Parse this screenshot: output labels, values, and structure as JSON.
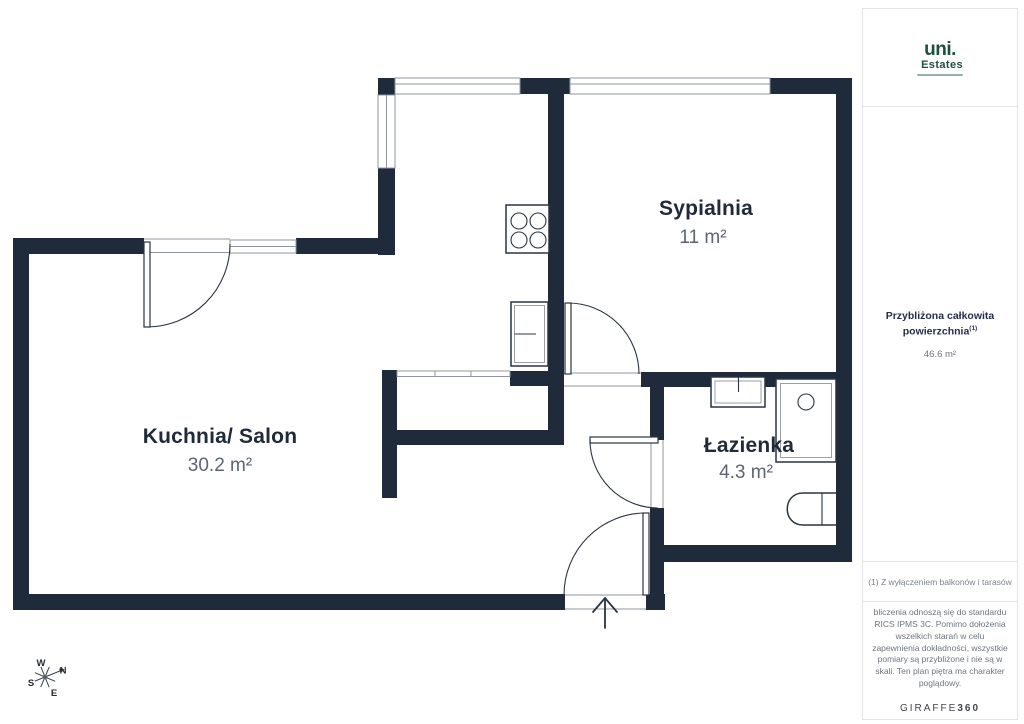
{
  "colors": {
    "wall": "#1f2a3a",
    "room_name": "#1f2a3a",
    "room_area": "#5d6572",
    "thin_line": "#8f959e",
    "fixture_line": "#2a3442",
    "sidebar_border": "#e4e4e4",
    "sidebar_text": "#6e757f",
    "heading": "#23304a",
    "logo_green": "#1d4f3c",
    "brand_dark": "#41464d",
    "footnote": "#7c828c"
  },
  "plan": {
    "rooms": [
      {
        "name": "Sypialnia",
        "area": "11 m²"
      },
      {
        "name": "Kuchnia/ Salon",
        "area": "30.2 m²"
      },
      {
        "name": "Łazienka",
        "area": "4.3 m²"
      }
    ],
    "compass": {
      "n": "N",
      "s": "S",
      "e": "E",
      "w": "W"
    }
  },
  "sidebar": {
    "logo": {
      "brand": "uni.",
      "sub": "Estates"
    },
    "total": {
      "heading": "Przybliżona całkowita powierzchnia",
      "footnote_mark": "(1)",
      "value": "46.6 m²"
    },
    "footnote": "(1) Z wyłączeniem balkonów i tarasów",
    "disclaimer": "bliczenia odnoszą się do standardu RICS IPMS 3C. Pomimo dołożenia wszelkich starań w celu zapewnienia dokładności, wszystkie pomiary są przybliżone i nie są w skali. Ten plan piętra ma charakter poglądowy.",
    "brand": {
      "name": "GIRAFFE",
      "suffix": "360"
    }
  }
}
